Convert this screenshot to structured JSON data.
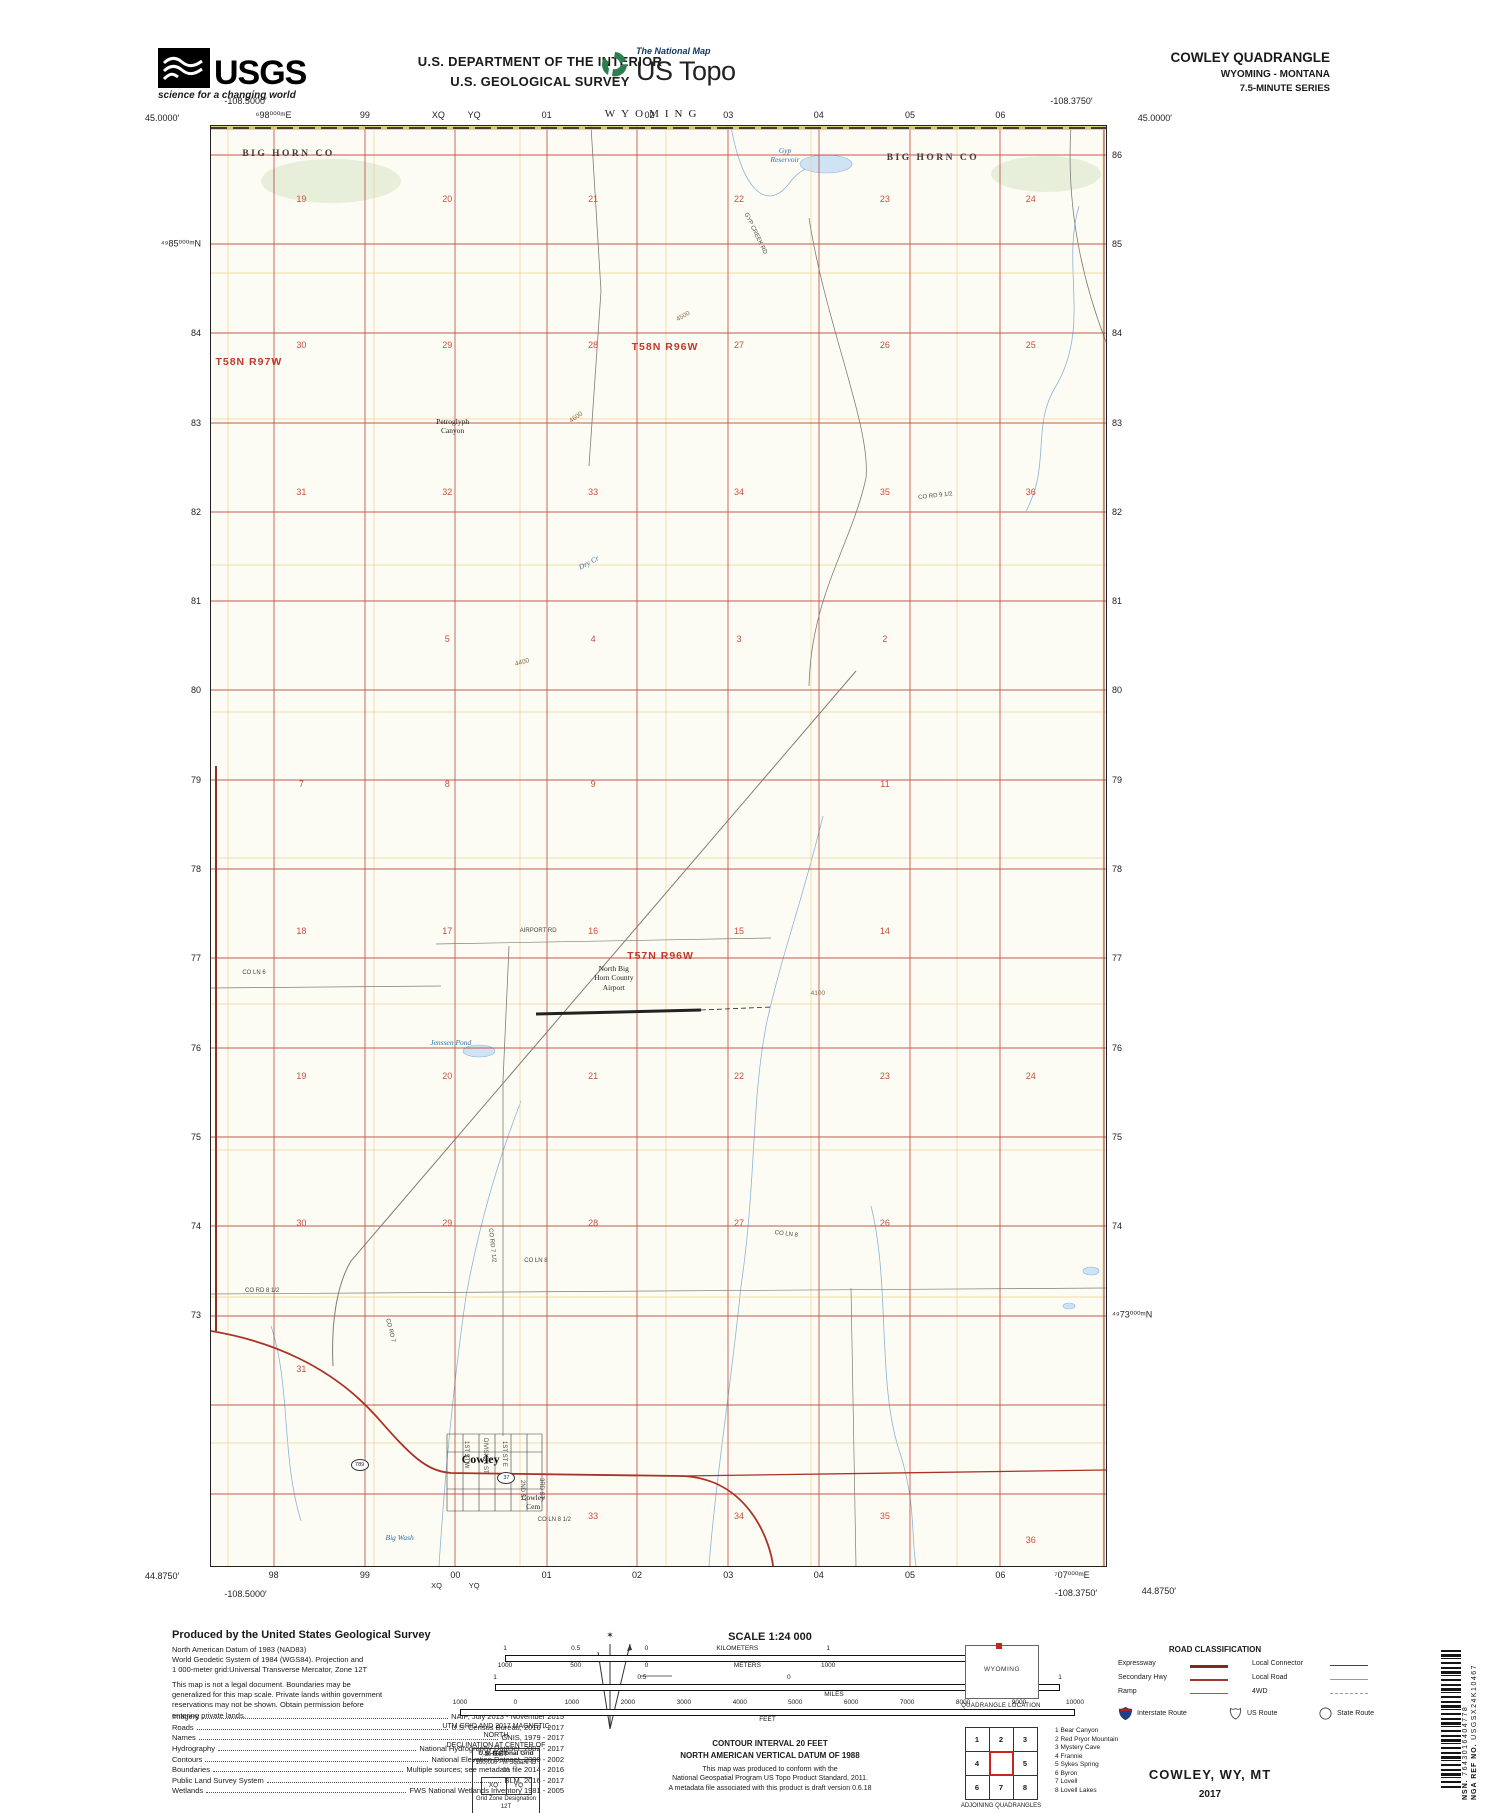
{
  "header": {
    "dept1": "U.S. DEPARTMENT OF THE INTERIOR",
    "dept2": "U.S. GEOLOGICAL SURVEY",
    "usgs": {
      "acronym": "USGS",
      "tagline": "science for a changing world"
    },
    "tnm": {
      "brand": "The National Map",
      "product": "US Topo"
    },
    "quad": {
      "name": "COWLEY QUADRANGLE",
      "states": "WYOMING - MONTANA",
      "series": "7.5-MINUTE SERIES"
    }
  },
  "map": {
    "state_top": "WYOMING",
    "corners": {
      "tl_lat": "45.0000′",
      "tl_lon": "-108.5000′",
      "tr_lat": "45.0000′",
      "tr_lon": "-108.3750′",
      "bl_lat": "44.8750′",
      "bl_lon": "-108.5000′",
      "br_lat": "44.8750′",
      "br_lon": "-108.3750′"
    },
    "top_edge": [
      {
        "t": "⁶98⁰⁰⁰ᵐE",
        "s": "left:7%"
      },
      {
        "t": "99",
        "s": "left:17.2%"
      },
      {
        "t": "XQ",
        "s": "left:25.4%"
      },
      {
        "t": "YQ",
        "s": "left:29.4%"
      },
      {
        "t": "01",
        "s": "left:37.5%"
      },
      {
        "t": "02",
        "s": "left:49%"
      },
      {
        "t": "03",
        "s": "left:57.8%"
      },
      {
        "t": "04",
        "s": "left:67.9%"
      },
      {
        "t": "05",
        "s": "left:78.1%"
      },
      {
        "t": "06",
        "s": "left:88.2%"
      }
    ],
    "bottom_edge": [
      {
        "t": "98",
        "s": "left:7%"
      },
      {
        "t": "99",
        "s": "left:17.2%"
      },
      {
        "t": "00",
        "s": "left:27.3%"
      },
      {
        "t": "01",
        "s": "left:37.5%"
      },
      {
        "t": "02",
        "s": "left:47.6%"
      },
      {
        "t": "03",
        "s": "left:57.8%"
      },
      {
        "t": "04",
        "s": "left:67.9%"
      },
      {
        "t": "05",
        "s": "left:78.1%"
      },
      {
        "t": "06",
        "s": "left:88.2%"
      },
      {
        "t": "⁷07⁰⁰⁰ᵐE",
        "s": "left:96.2%"
      }
    ],
    "bottom_edge_small": [
      {
        "t": "XQ",
        "s": "left:25.2%"
      },
      {
        "t": "YQ",
        "s": "left:29.4%"
      }
    ],
    "left_edge": [
      {
        "t": "⁴⁹85⁰⁰⁰ᵐN",
        "s": "top:8.2%"
      },
      {
        "t": "84",
        "s": "top:14.4%"
      },
      {
        "t": "83",
        "s": "top:20.6%"
      },
      {
        "t": "82",
        "s": "top:26.8%"
      },
      {
        "t": "81",
        "s": "top:33%"
      },
      {
        "t": "80",
        "s": "top:39.2%"
      },
      {
        "t": "79",
        "s": "top:45.4%"
      },
      {
        "t": "78",
        "s": "top:51.6%"
      },
      {
        "t": "77",
        "s": "top:57.8%"
      },
      {
        "t": "76",
        "s": "top:64%"
      },
      {
        "t": "75",
        "s": "top:70.2%"
      },
      {
        "t": "74",
        "s": "top:76.4%"
      },
      {
        "t": "73",
        "s": "top:82.6%"
      }
    ],
    "right_edge": [
      {
        "t": "86",
        "s": "top:2%"
      },
      {
        "t": "85",
        "s": "top:8.2%"
      },
      {
        "t": "84",
        "s": "top:14.4%"
      },
      {
        "t": "83",
        "s": "top:20.6%"
      },
      {
        "t": "82",
        "s": "top:26.8%"
      },
      {
        "t": "81",
        "s": "top:33%"
      },
      {
        "t": "80",
        "s": "top:39.2%"
      },
      {
        "t": "79",
        "s": "top:45.4%"
      },
      {
        "t": "78",
        "s": "top:51.6%"
      },
      {
        "t": "77",
        "s": "top:57.8%"
      },
      {
        "t": "76",
        "s": "top:64%"
      },
      {
        "t": "75",
        "s": "top:70.2%"
      },
      {
        "t": "74",
        "s": "top:76.4%"
      },
      {
        "t": "⁴⁹73⁰⁰⁰ᵐN",
        "s": "top:82.6%"
      }
    ],
    "counties": [
      {
        "t": "BIG HORN CO",
        "s": "left:3.5%;top:1.6%"
      },
      {
        "t": "BIG HORN CO",
        "s": "left:75.5%;top:1.9%"
      }
    ],
    "townships": [
      {
        "t": "T58N R97W",
        "s": "left:0.5%;top:16%"
      },
      {
        "t": "T58N R96W",
        "s": "left:47%;top:14.9%"
      },
      {
        "t": "T57N R96W",
        "s": "left:46.5%;top:57.2%"
      }
    ],
    "sections": [
      {
        "t": "19",
        "s": "left:10.1%;top:5.1%"
      },
      {
        "t": "20",
        "s": "left:26.4%;top:5.1%"
      },
      {
        "t": "21",
        "s": "left:42.7%;top:5.1%"
      },
      {
        "t": "22",
        "s": "left:59%;top:5.1%"
      },
      {
        "t": "23",
        "s": "left:75.3%;top:5.1%"
      },
      {
        "t": "24",
        "s": "left:91.6%;top:5.1%"
      },
      {
        "t": "30",
        "s": "left:10.1%;top:15.2%"
      },
      {
        "t": "29",
        "s": "left:26.4%;top:15.2%"
      },
      {
        "t": "28",
        "s": "left:42.7%;top:15.2%"
      },
      {
        "t": "27",
        "s": "left:59%;top:15.2%"
      },
      {
        "t": "26",
        "s": "left:75.3%;top:15.2%"
      },
      {
        "t": "25",
        "s": "left:91.6%;top:15.2%"
      },
      {
        "t": "31",
        "s": "left:10.1%;top:25.4%"
      },
      {
        "t": "32",
        "s": "left:26.4%;top:25.4%"
      },
      {
        "t": "33",
        "s": "left:42.7%;top:25.4%"
      },
      {
        "t": "34",
        "s": "left:59%;top:25.4%"
      },
      {
        "t": "35",
        "s": "left:75.3%;top:25.4%"
      },
      {
        "t": "36",
        "s": "left:91.6%;top:25.4%"
      },
      {
        "t": "5",
        "s": "left:26.4%;top:35.6%"
      },
      {
        "t": "4",
        "s": "left:42.7%;top:35.6%"
      },
      {
        "t": "3",
        "s": "left:59%;top:35.6%"
      },
      {
        "t": "2",
        "s": "left:75.3%;top:35.6%"
      },
      {
        "t": "7",
        "s": "left:10.1%;top:45.7%"
      },
      {
        "t": "8",
        "s": "left:26.4%;top:45.7%"
      },
      {
        "t": "9",
        "s": "left:42.7%;top:45.7%"
      },
      {
        "t": "11",
        "s": "left:75.3%;top:45.7%"
      },
      {
        "t": "18",
        "s": "left:10.1%;top:55.9%"
      },
      {
        "t": "17",
        "s": "left:26.4%;top:55.9%"
      },
      {
        "t": "16",
        "s": "left:42.7%;top:55.9%"
      },
      {
        "t": "15",
        "s": "left:59%;top:55.9%"
      },
      {
        "t": "14",
        "s": "left:75.3%;top:55.9%"
      },
      {
        "t": "19",
        "s": "left:10.1%;top:66%"
      },
      {
        "t": "20",
        "s": "left:26.4%;top:66%"
      },
      {
        "t": "21",
        "s": "left:42.7%;top:66%"
      },
      {
        "t": "22",
        "s": "left:59%;top:66%"
      },
      {
        "t": "23",
        "s": "left:75.3%;top:66%"
      },
      {
        "t": "24",
        "s": "left:91.6%;top:66%"
      },
      {
        "t": "30",
        "s": "left:10.1%;top:76.2%"
      },
      {
        "t": "29",
        "s": "left:26.4%;top:76.2%"
      },
      {
        "t": "28",
        "s": "left:42.7%;top:76.2%"
      },
      {
        "t": "27",
        "s": "left:59%;top:76.2%"
      },
      {
        "t": "26",
        "s": "left:75.3%;top:76.2%"
      },
      {
        "t": "31",
        "s": "left:10.1%;top:86.3%"
      },
      {
        "t": "33",
        "s": "left:42.7%;top:96.5%"
      },
      {
        "t": "34",
        "s": "left:59%;top:96.5%"
      },
      {
        "t": "35",
        "s": "left:75.3%;top:96.5%"
      },
      {
        "t": "36",
        "s": "left:91.6%;top:98.2%"
      }
    ],
    "elevations": [
      {
        "t": "4600",
        "s": "left:40%;top:20%;transform:rotate(-35deg)"
      },
      {
        "t": "4500",
        "s": "left:52%;top:13%;transform:rotate(-30deg)"
      },
      {
        "t": "4400",
        "s": "left:34%;top:37%;transform:rotate(-15deg)"
      },
      {
        "t": "4100",
        "s": "left:67%;top:60%"
      }
    ],
    "places": [
      {
        "t": "Petroglyph\nCanyon",
        "s": "left:27%;top:20.2%"
      },
      {
        "t": "North Big\nHorn County\nAirport",
        "s": "left:45%;top:58.2%"
      },
      {
        "t": "Cowley\nCem",
        "s": "left:36%;top:94.9%"
      }
    ],
    "town": {
      "name": "Cowley",
      "s": "left:28%;top:92.1%"
    },
    "waters": [
      {
        "t": "Gyp\nReservoir",
        "s": "left:62.5%;top:1.4%"
      },
      {
        "t": "Jenssen Pond",
        "s": "left:24.5%;top:63.3%"
      },
      {
        "t": "Dry Cr",
        "s": "left:41%;top:30%;transform:rotate(-28deg)"
      },
      {
        "t": "Big Wash",
        "s": "left:19.5%;top:97.7%"
      }
    ],
    "roads": [
      {
        "t": "GYP CREEK RD",
        "s": "left:60%;top:6%;transform:rotate(64deg)"
      },
      {
        "t": "CO RD 9 1/2",
        "s": "left:79%;top:25.6%;transform:rotate(-6deg)"
      },
      {
        "t": "CO LN 6",
        "s": "left:3.5%;top:58.6%"
      },
      {
        "t": "AIRPORT RD",
        "s": "left:34.5%;top:55.7%"
      },
      {
        "t": "CO RD 7 1/2",
        "s": "left:31.5%;top:76.5%;transform:rotate(84deg)"
      },
      {
        "t": "CO LN 8",
        "s": "left:63%;top:76.7%;transform:rotate(7deg)"
      },
      {
        "t": "CO LN 8",
        "s": "left:35%;top:78.6%"
      },
      {
        "t": "CO RD 8 1/2",
        "s": "left:3.8%;top:80.7%"
      },
      {
        "t": "CO RD 7",
        "s": "left:20%;top:82.8%;transform:rotate(76deg)"
      },
      {
        "t": "CO LN 8 1/2",
        "s": "left:36.5%;top:96.6%"
      },
      {
        "t": "1ST ST W",
        "s": "left:28.8%;top:91.3%;transform:rotate(90deg)"
      },
      {
        "t": "DIVISION ST",
        "s": "left:31%;top:91.1%;transform:rotate(90deg)"
      },
      {
        "t": "1ST ST E",
        "s": "left:33.1%;top:91.3%;transform:rotate(90deg)"
      },
      {
        "t": "2ND ST",
        "s": "left:35.1%;top:94%;transform:rotate(90deg)"
      },
      {
        "t": "3RD ST",
        "s": "left:37.2%;top:93.9%;transform:rotate(90deg)"
      }
    ],
    "shields": [
      {
        "t": "789",
        "s": "left:15.6%;top:92.6%"
      },
      {
        "t": "37",
        "s": "left:32%;top:93.5%"
      }
    ]
  },
  "footer": {
    "produced_title": "Produced by the United States Geological Survey",
    "note1": "North American Datum of 1983 (NAD83)\nWorld Geodetic System of 1984 (WGS84).  Projection and\n1 000-meter grid:Universal Transverse Mercator, Zone 12T",
    "note2": "This map is not a legal document. Boundaries may be\ngeneralized for this map scale. Private lands within government\nreservations may not be shown. Obtain permission before\nentering private lands.",
    "credits": [
      {
        "k": "Imagery",
        "v": "NAIP, July 2013 - November 2015"
      },
      {
        "k": "Roads",
        "v": "U.S. Census Bureau, 2016 - 2017"
      },
      {
        "k": "Names",
        "v": "GNIS, 1979 - 2017"
      },
      {
        "k": "Hydrography",
        "v": "National Hydrography Dataset, 2002 - 2017"
      },
      {
        "k": "Contours",
        "v": "National Elevation Dataset, 2000 - 2002"
      },
      {
        "k": "Boundaries",
        "v": "Multiple sources; see metadata file 2014 - 2016"
      },
      {
        "k": "Public Land Survey System",
        "v": "BLM, 2016 - 2017"
      },
      {
        "k": "Wetlands",
        "v": "FWS National Wetlands Inventory 1981 - 2005"
      }
    ],
    "decl": {
      "star": "✶",
      "mn": "MN",
      "gn": "GN",
      "a1": "1°49′",
      "m1": "32 MILS",
      "a2": "10°35′",
      "m2": "188 MILS",
      "caption": "UTM GRID AND 2017 MAGNETIC NORTH\nDECLINATION AT CENTER OF SHEET"
    },
    "usng": {
      "title": "U.S. National Grid",
      "sq": "100,000 - m Square ID",
      "id": "00",
      "c1": "XQ",
      "c2": "YQ",
      "gz": "Grid Zone Designation",
      "zone": "12T"
    },
    "scale": {
      "title": "SCALE 1:24 000",
      "b1_top": [
        {
          "t": "1",
          "s": "left:0%"
        },
        {
          "t": "0.5",
          "s": "left:14%"
        },
        {
          "t": "0",
          "s": "left:28%"
        },
        {
          "t": "KILOMETERS",
          "s": "left:46%"
        },
        {
          "t": "1",
          "s": "left:64%"
        },
        {
          "t": "2",
          "s": "left:100%"
        }
      ],
      "b1_bot": [
        {
          "t": "1000",
          "s": "left:0%"
        },
        {
          "t": "500",
          "s": "left:14%"
        },
        {
          "t": "0",
          "s": "left:28%"
        },
        {
          "t": "METERS",
          "s": "left:48%"
        },
        {
          "t": "1000",
          "s": "left:64%"
        },
        {
          "t": "2000",
          "s": "left:100%"
        }
      ],
      "b2_top": [
        {
          "t": "1",
          "s": "left:0%"
        },
        {
          "t": "0.5",
          "s": "left:26%"
        },
        {
          "t": "0",
          "s": "left:52%"
        },
        {
          "t": "1",
          "s": "left:100%"
        }
      ],
      "miles": "MILES",
      "b3_top": [
        {
          "t": "1000",
          "s": "left:0%"
        },
        {
          "t": "0",
          "s": "left:9%"
        },
        {
          "t": "1000",
          "s": "left:18.2%"
        },
        {
          "t": "2000",
          "s": "left:27.3%"
        },
        {
          "t": "3000",
          "s": "left:36.4%"
        },
        {
          "t": "4000",
          "s": "left:45.5%"
        },
        {
          "t": "5000",
          "s": "left:54.5%"
        },
        {
          "t": "6000",
          "s": "left:63.6%"
        },
        {
          "t": "7000",
          "s": "left:72.7%"
        },
        {
          "t": "8000",
          "s": "left:81.8%"
        },
        {
          "t": "9000",
          "s": "left:90.9%"
        },
        {
          "t": "10000",
          "s": "left:100%"
        }
      ],
      "feet": "FEET"
    },
    "contour": "CONTOUR INTERVAL 20 FEET",
    "datum": "NORTH AMERICAN VERTICAL DATUM OF 1988",
    "conform": "This map was produced to conform with the\nNational Geospatial Program US Topo Product Standard, 2011.\nA metadata file associated with this product is draft version 0.6.18",
    "quadloc": {
      "state": "WYOMING",
      "caption": "QUADRANGLE LOCATION"
    },
    "adjoining": {
      "grid": [
        "1",
        "2",
        "3",
        "4",
        "",
        "5",
        "6",
        "7",
        "8"
      ],
      "caption": "ADJOINING QUADRANGLES",
      "list": [
        {
          "n": "1",
          "name": "Bear Canyon"
        },
        {
          "n": "2",
          "name": "Red Pryor Mountain"
        },
        {
          "n": "3",
          "name": "Mystery Cave"
        },
        {
          "n": "4",
          "name": "Frannie"
        },
        {
          "n": "5",
          "name": "Sykes Spring"
        },
        {
          "n": "6",
          "name": "Byron"
        },
        {
          "n": "7",
          "name": "Lovell"
        },
        {
          "n": "8",
          "name": "Lovell Lakes"
        }
      ]
    },
    "roadclass": {
      "title": "ROAD CLASSIFICATION",
      "left_rows": [
        {
          "t": "Expressway",
          "c": "sw-exp"
        },
        {
          "t": "Secondary Hwy",
          "c": "sw-sec"
        },
        {
          "t": "Ramp",
          "c": "sw-ramp"
        }
      ],
      "right_rows": [
        {
          "t": "Local Connector",
          "c": "sw-lc"
        },
        {
          "t": "Local Road",
          "c": "sw-lr"
        },
        {
          "t": "4WD",
          "c": "sw-4wd"
        }
      ],
      "interstate": "Interstate Route",
      "us": "US Route",
      "state": "State Route"
    },
    "imprint": {
      "name": "COWLEY,  WY, MT",
      "year": "2017"
    },
    "barcode": {
      "nsn_label": "NSN.",
      "nsn": "7643016404778",
      "nga_label": "NGA REF NO.",
      "nga": "USGSX24K10467"
    }
  },
  "colors": {
    "contour": "#c49a6c",
    "contour_index": "#a5713f",
    "utm_grid": "#bf4a3f",
    "section_line": "#ecd28e",
    "water": "#8ab4d8",
    "highway": "#a93226",
    "topo_green": "#2e7d4f"
  }
}
